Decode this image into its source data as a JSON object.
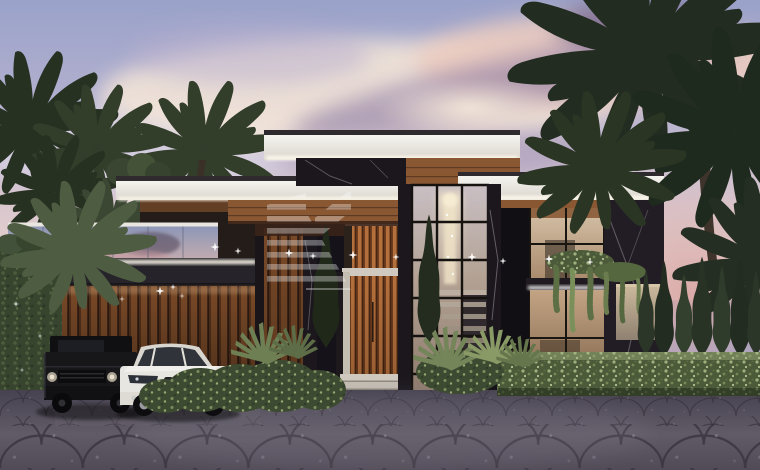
{
  "scene": {
    "setting": "Architectural rendering of a modern luxury villa exterior at dusk",
    "watermark": {
      "style": "translucent striped monogram",
      "opacity": "0.33"
    },
    "elements": {
      "sky": "Lavender dusk sky",
      "clouds": "Pink and purple sunset clouds",
      "palms_left": "Dark palm trees at left",
      "palm_center": "Palm canopy above left roof",
      "palms_right": "Large palm grove at right",
      "villa": "Two-storey modern villa with flat roofs",
      "roof_top": "Top white fascia roof with LED strip",
      "roof_left": "Left white fascia roof with LED strip",
      "roof_right": "Right white fascia roof with LED strip",
      "balcony": "Glass balustrade balcony with palm reflections",
      "carport": "Wood slat carport",
      "ivy_wall": "Ivy covered wall with twinkle lights",
      "atrium": "Double height glazed atrium",
      "chandelier": "Cascading crystal chandelier",
      "staircase": "Interior staircase behind glass",
      "entrance": "Entrance bay with copper wood louvres",
      "door": "Wood slat pivot door",
      "steps": "White entry steps",
      "left_facade": "Dark marble and wood louvre facade",
      "right_wing": "Right wing with warm lit windows",
      "planter": "LED lit planter ledge",
      "hanging_plants": "Greenery draping from ledge",
      "garden_wall": "Warm lit garden wall",
      "cypress_row": "Row of cypress shrubs",
      "cypress_front": "Slender cypress trees at facade",
      "hedge": "Trimmed speckled hedge row",
      "bushes": "Low garden bushes",
      "tropical_plants": "Spiky tropical plants",
      "driveway": "Fan pattern cobblestone driveway",
      "car_black": "Black boxy luxury SUV",
      "car_white": "White luxury SUV",
      "sparkles": "Sparkling facade lights",
      "watermark": "Translucent striped monogram watermark"
    }
  },
  "colors": {
    "sky_top": "#9aa2c9",
    "sky_mid": "#b3b0cf",
    "sky_pink": "#d8c6cd",
    "sky_low": "#eedbd2",
    "cloud_cream": "#f6e7d8",
    "cloud_pink": "#ecccc0",
    "cloud_purple": "#8d7ca3",
    "cloud_dark": "#6f6089",
    "cloud_soft": "#d9d4e6",
    "sunset_glow": "#d9a8a6",
    "palm_dark": "#273122",
    "palm_mid": "#323d2a",
    "palm_light": "#3b4733",
    "frond_front": "#4e5c41",
    "fascia_white": "#f6f4ef",
    "fascia_shade": "#d9d5cd",
    "led_glow": "#fff9ec",
    "wood_soffit": "#8a5733",
    "wood_dark": "#52311c",
    "copper": "#b4703c",
    "marble_black": "#1b171d",
    "marble_vein": "#cfc9d2",
    "glass_cool_top": "#8d97b8",
    "glass_cool_bottom": "#c9aeae",
    "glass_warm": "#d6c2a8",
    "glass_warm_deep": "#a98a6c",
    "interior_glow": "#f0e4c8",
    "ivy_green": "#37452e",
    "hedge_green": "#4b5a39",
    "hedge_light": "#9fae7d",
    "cypress_green": "#2b3628",
    "plant_blade": "#75855a",
    "pavement_dark": "#474250",
    "pavement_mid": "#615b67",
    "cobble_line": "#39343f",
    "step_white": "#cfc9bf",
    "wall_tan": "#cdbb9e",
    "car_black": "#17171a",
    "car_white": "#e8e6e1",
    "window_tint": "#272b31",
    "watermark_white": "#ffffff"
  }
}
